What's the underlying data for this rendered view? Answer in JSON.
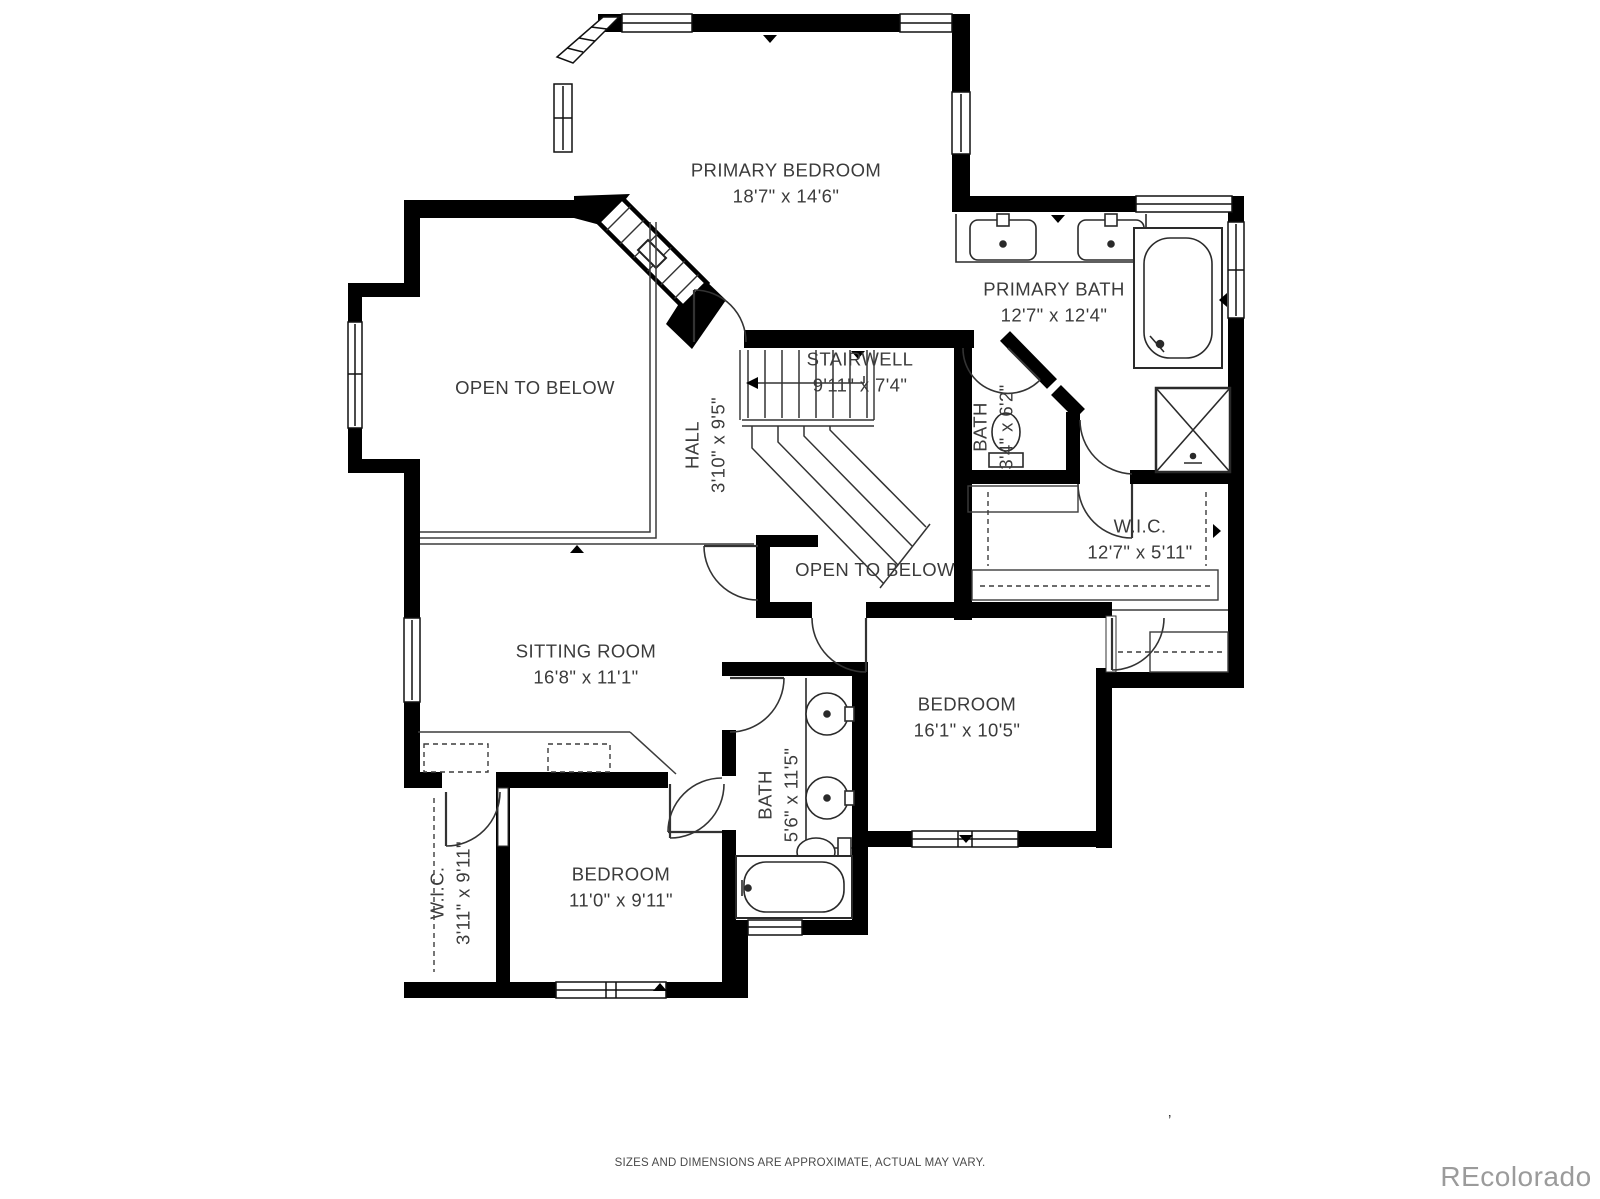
{
  "plan": {
    "rooms": [
      {
        "id": "primary-bedroom",
        "name": "PRIMARY BEDROOM",
        "dims": "18'7\" x 14'6\""
      },
      {
        "id": "primary-bath",
        "name": "PRIMARY BATH",
        "dims": "12'7\" x 12'4\""
      },
      {
        "id": "stairwell",
        "name": "STAIRWELL",
        "dims": "9'11\" x 7'4\""
      },
      {
        "id": "open-to-below-left",
        "name": "OPEN TO BELOW",
        "dims": ""
      },
      {
        "id": "hall",
        "name": "HALL",
        "dims": "3'10\" x 9'5\""
      },
      {
        "id": "bath-toilet",
        "name": "BATH",
        "dims": "3'4\" x 6'2\""
      },
      {
        "id": "wic-primary",
        "name": "W.I.C.",
        "dims": "12'7\" x 5'11\""
      },
      {
        "id": "open-to-below-center",
        "name": "OPEN TO BELOW",
        "dims": ""
      },
      {
        "id": "sitting-room",
        "name": "SITTING ROOM",
        "dims": "16'8\" x 11'1\""
      },
      {
        "id": "bedroom-right",
        "name": "BEDROOM",
        "dims": "16'1\" x 10'5\""
      },
      {
        "id": "bath-jack-and-jill",
        "name": "BATH",
        "dims": "5'6\" x 11'5\""
      },
      {
        "id": "bedroom-left",
        "name": "BEDROOM",
        "dims": "11'0\" x 9'11\""
      },
      {
        "id": "wic-left",
        "name": "W.I.C.",
        "dims": "3'11\" x 9'11\""
      }
    ],
    "footer": {
      "disclaimer": "SIZES AND DIMENSIONS ARE APPROXIMATE, ACTUAL MAY VARY."
    },
    "watermark": "REcolorado",
    "stray_mark": "’",
    "colors": {
      "wall": "#000000",
      "text": "#3b3b3b",
      "watermark": "#9b9b9b"
    }
  }
}
